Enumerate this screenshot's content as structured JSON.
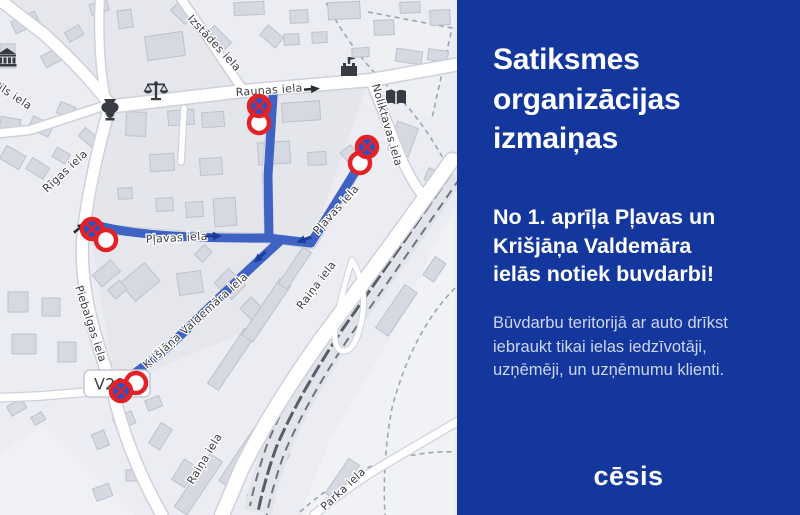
{
  "panel": {
    "title": "Satiksmes organizācijas izmaiņas",
    "subtitle": "No 1. aprīļa Pļavas un Krišjāņa Valdemāra ielās notiek buvdarbi!",
    "body": "Būvdarbu teritorijā ar auto drīkst iebraukt tikai ielas iedzīvotāji, uzņēmēji, un uzņēmumu klienti.",
    "logo_text": "cēsis",
    "background_color": "#14379d"
  },
  "map": {
    "road_number_badge": "V294",
    "street_labels": [
      {
        "name": "Izstādes iela"
      },
      {
        "name": "Raunas iela"
      },
      {
        "name": "Noliktavas iela"
      },
      {
        "name": "Pils iela"
      },
      {
        "name": "Rīgas iela"
      },
      {
        "name": "Pļavas iela"
      },
      {
        "name": "Pļavas iela"
      },
      {
        "name": "Krišjāņa Valdemāra iela"
      },
      {
        "name": "Piebalgas iela"
      },
      {
        "name": "Raiņa iela"
      },
      {
        "name": "Raiņa iela"
      },
      {
        "name": "Parka iela"
      }
    ],
    "colors": {
      "route_blue": "#3e63c4",
      "route_arrow_navy": "#1b3c9d",
      "sign_red": "#e32127",
      "sign_blue": "#2a52c4",
      "map_background": "#ecedf2"
    }
  }
}
